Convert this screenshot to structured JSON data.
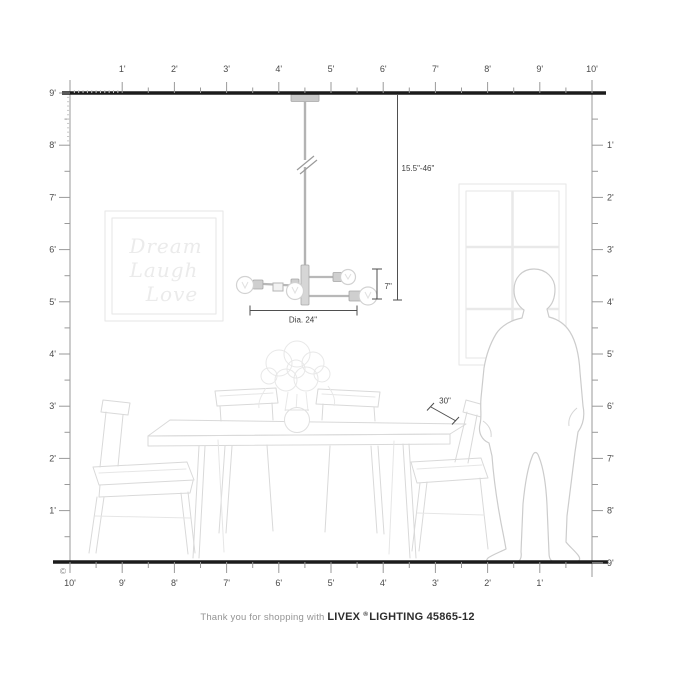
{
  "rulers": {
    "top": [
      "1'",
      "2'",
      "3'",
      "4'",
      "5'",
      "6'",
      "7'",
      "8'",
      "9'",
      "10'"
    ],
    "left": [
      "9'",
      "8'",
      "7'",
      "6'",
      "5'",
      "4'",
      "3'",
      "2'",
      "1'"
    ],
    "right": [
      "1'",
      "2'",
      "3'",
      "4'",
      "5'",
      "6'",
      "7'",
      "8'",
      "9'"
    ],
    "bottom": [
      "10'",
      "9'",
      "8'",
      "7'",
      "6'",
      "5'",
      "4'",
      "3'",
      "2'",
      "1'"
    ]
  },
  "copyright": "©",
  "measurements": {
    "hanging_height": "15.5\"-46\"",
    "fixture_height": "7\"",
    "diameter": "Dia. 24\"",
    "table_clearance": "30\""
  },
  "wall_art": {
    "line1": "Dream",
    "line2": "Laugh",
    "line3": "Love"
  },
  "footer": {
    "prefix": "Thank you for shopping with",
    "brand": "LIVEX",
    "registered": "®",
    "suffix": "LIGHTING 45865-12"
  }
}
